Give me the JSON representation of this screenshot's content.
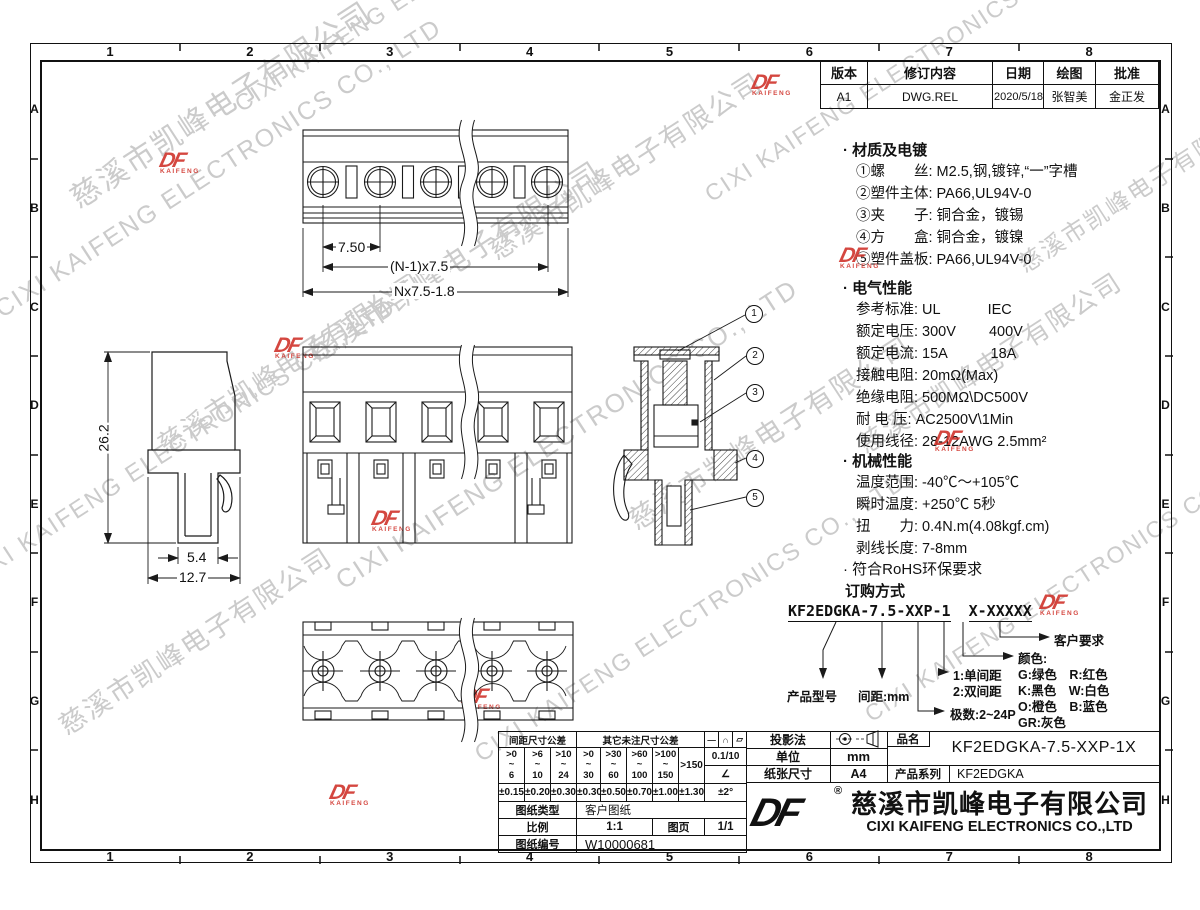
{
  "bullet": "·",
  "grid": {
    "cols": [
      "1",
      "2",
      "3",
      "4",
      "5",
      "6",
      "7",
      "8"
    ],
    "rows": [
      "A",
      "B",
      "C",
      "D",
      "E",
      "F",
      "G",
      "H"
    ]
  },
  "revision": {
    "headers": [
      "版本",
      "修订内容",
      "日期",
      "绘图",
      "批准"
    ],
    "row": [
      "A1",
      "DWG.REL",
      "2020/5/18",
      "张智美",
      "金正发"
    ]
  },
  "materials": {
    "title": "材质及电镀",
    "items": [
      "①螺　　丝: M2.5,钢,镀锌,“一”字槽",
      "②塑件主体: PA66,UL94V-0",
      "③夹　　子: 铜合金，镀锡",
      "④方　　盒: 铜合金，镀镍",
      "⑤塑件盖板: PA66,UL94V-0"
    ]
  },
  "electrical": {
    "title": "电气性能",
    "items": [
      "参考标准: UL　　　 IEC",
      "额定电压: 300V　　 400V",
      "额定电流: 15A　　　18A",
      "接触电阻: 20mΩ(Max)",
      "绝缘电阻: 500MΩ\\DC500V",
      "耐 电 压: AC2500V\\1Min",
      "使用线径: 28-12AWG 2.5mm²"
    ]
  },
  "mechanical": {
    "title": "机械性能",
    "items": [
      "温度范围: -40℃～+105℃",
      "瞬时温度: +250℃  5秒",
      "扭　　力: 0.4N.m(4.08kgf.cm)",
      "剥线长度: 7-8mm"
    ]
  },
  "rohs": "符合RoHS环保要求",
  "ordering": {
    "title": "订购方式",
    "code_left": "KF2EDGKA-7.5-XXP-1",
    "code_right": "X-XXXXX",
    "product": "产品型号",
    "pitch": "间距:mm",
    "poles": "极数:2~24P",
    "pitch_type_1": "1:单间距",
    "pitch_type_2": "2:双间距",
    "color_title": "颜色:",
    "colors": [
      "G:绿色　R:红色",
      "K:黑色　W:白色",
      "O:橙色　B:蓝色",
      "GR:灰色"
    ],
    "customer": "客户要求"
  },
  "dims": {
    "pitch": "7.50",
    "span": "(N-1)x7.5",
    "total": "Nx7.5-1.8",
    "height": "26.2",
    "leg": "5.4",
    "width": "12.7"
  },
  "callouts": [
    "1",
    "2",
    "3",
    "4",
    "5"
  ],
  "tol": {
    "pitch_header": "间距尺寸公差",
    "other_header": "其它未注尺寸公差",
    "symbols": [
      "—",
      "∩",
      "▱"
    ],
    "sep": "~",
    "ranges": [
      [
        ">0",
        "6"
      ],
      [
        ">6",
        "10"
      ],
      [
        ">10",
        "24"
      ],
      [
        ">0",
        "30"
      ],
      [
        ">30",
        "60"
      ],
      [
        ">60",
        "100"
      ],
      [
        ">100",
        "150"
      ]
    ],
    "range_last": ">150",
    "grad": "0.1/10",
    "angle": "∠",
    "tols": [
      "±0.15",
      "±0.20",
      "±0.30",
      "±0.30",
      "±0.50",
      "±0.70",
      "±1.00",
      "±1.30"
    ],
    "angle_tol": "±2°",
    "type_label": "图纸类型",
    "type_value": "客户图纸",
    "scale_label": "比例",
    "scale_value": "1:1",
    "page_label": "图页",
    "page_value": "1/1",
    "no_label": "图纸编号",
    "no_value": "W10000681"
  },
  "titleblock": {
    "projection": "投影法",
    "unit_label": "单位",
    "unit": "mm",
    "paper_label": "纸张尺寸",
    "paper": "A4",
    "name_label": "品名",
    "name": "KF2EDGKA-7.5-XXP-1X",
    "series_label": "产品系列",
    "series": "KF2EDGKA",
    "logo": "DF",
    "reg": "®",
    "company_cn": "慈溪市凯峰电子有限公司",
    "company_en": "CIXI KAIFENG ELECTRONICS CO.,LTD"
  },
  "watermark": {
    "cn": "慈溪市凯峰电子有限公司",
    "en": "CIXI KAIFENG ELECTRONICS CO., LTD",
    "logo": "DF",
    "logo_sub": "KAIFENG"
  }
}
